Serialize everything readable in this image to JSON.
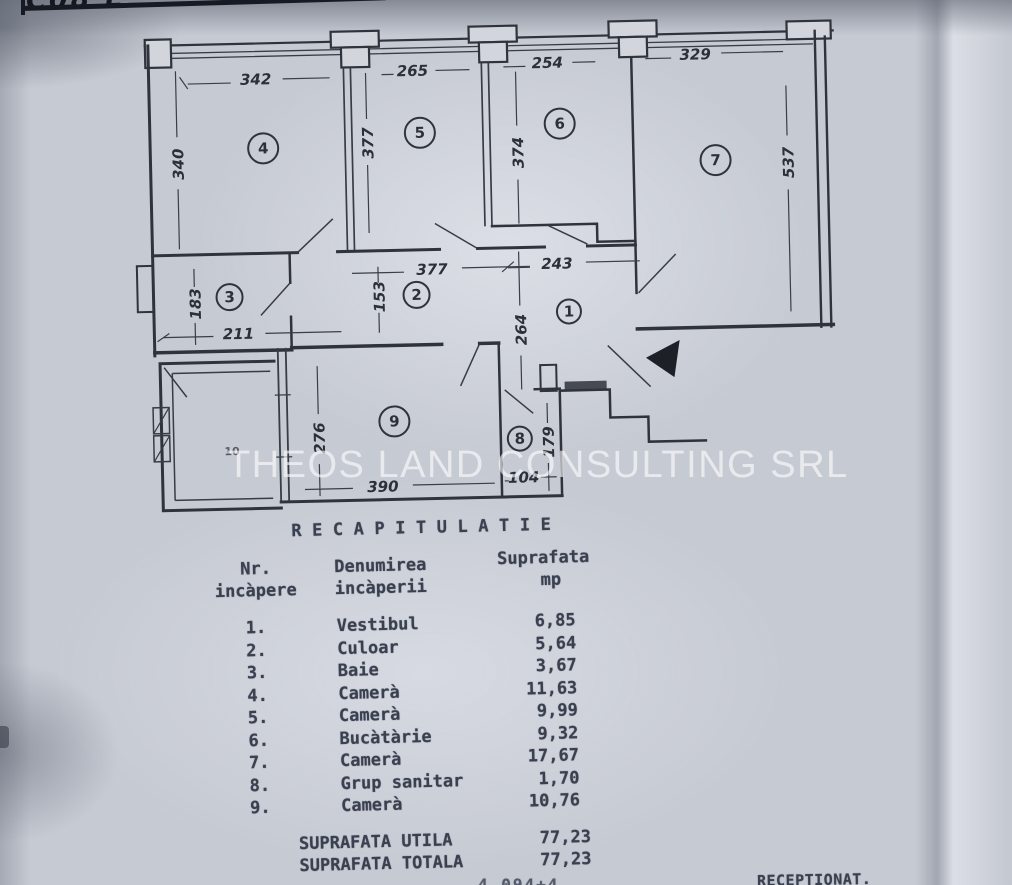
{
  "page": {
    "corner_note": "C08 E",
    "watermark": "THEOS LAND CONSULTING SRL",
    "bottom_partial": "4,094+4",
    "receptionat": "RECEPTIONAT."
  },
  "plan": {
    "rooms": {
      "r1": "1",
      "r2": "2",
      "r3": "3",
      "r4": "4",
      "r5": "5",
      "r6": "6",
      "r7": "7",
      "r8": "8",
      "r9": "9",
      "r10": "10"
    },
    "dims": {
      "room4_width": "342",
      "room5_width": "265",
      "room6_width": "254",
      "room7_width": "329",
      "room4_height": "340",
      "room5_height": "377",
      "room6_height": "374",
      "room7_height": "537",
      "corridor_width": "377",
      "vestibul_width": "243",
      "corridor_height": "153",
      "bath_width": "211",
      "bath_height": "183",
      "vestibul_height": "264",
      "room9_height": "276",
      "room9_width": "390",
      "room8_width": "104",
      "room8_height": "179"
    }
  },
  "table": {
    "title": "RECAPITULATIE",
    "col1_line1": "Nr.",
    "col1_line2": "incàpere",
    "col2_line1": "Denumirea",
    "col2_line2": "incàperii",
    "col3_line1": "Suprafata",
    "col3_line2": "mp",
    "rows": [
      {
        "nr": "1.",
        "name": "Vestibul",
        "area": "6,85"
      },
      {
        "nr": "2.",
        "name": "Culoar",
        "area": "5,64"
      },
      {
        "nr": "3.",
        "name": "Baie",
        "area": "3,67"
      },
      {
        "nr": "4.",
        "name": "Camerà",
        "area": "11,63"
      },
      {
        "nr": "5.",
        "name": "Camerà",
        "area": "9,99"
      },
      {
        "nr": "6.",
        "name": "Bucàtàrie",
        "area": "9,32"
      },
      {
        "nr": "7.",
        "name": "Camerà",
        "area": "17,67"
      },
      {
        "nr": "8.",
        "name": "Grup sanitar",
        "area": "1,70"
      },
      {
        "nr": "9.",
        "name": "Camerà",
        "area": "10,76"
      }
    ],
    "totals": [
      {
        "label": "SUPRAFATA UTILA",
        "value": "77,23"
      },
      {
        "label": "SUPRAFATA TOTALA",
        "value": "77,23"
      }
    ]
  }
}
